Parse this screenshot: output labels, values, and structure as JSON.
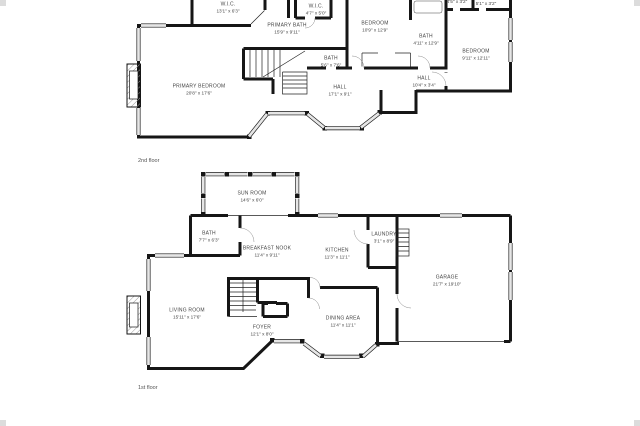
{
  "colors": {
    "wall": "#161616",
    "window": "#e6e6e6",
    "text": "#454545",
    "background": "#ffffff"
  },
  "floors": [
    {
      "label": "2nd floor",
      "rooms": [
        {
          "name": "W.I.C.",
          "dims": "13'1\" x 6'3\""
        },
        {
          "name": "PRIMARY BATH",
          "dims": "15'9\" x 9'11\""
        },
        {
          "name": "W.I.C.",
          "dims": "4'7\" x 5'0\""
        },
        {
          "name": "BEDROOM",
          "dims": "10'9\" x 12'9\""
        },
        {
          "name": "BATH",
          "dims": "4'11\" x 12'9\""
        },
        {
          "name": "",
          "dims": "4'5\" x 3'2\""
        },
        {
          "name": "",
          "dims": "5'1\" x 3'2\""
        },
        {
          "name": "BEDROOM",
          "dims": "9'11\" x 12'11\""
        },
        {
          "name": "HALL",
          "dims": "10'4\" x 3'4\""
        },
        {
          "name": "BATH",
          "dims": "5'6\" x 7'6\""
        },
        {
          "name": "HALL",
          "dims": "17'1\" x 9'1\""
        },
        {
          "name": "PRIMARY BEDROOM",
          "dims": "20'8\" x 17'6\""
        }
      ]
    },
    {
      "label": "1st floor",
      "rooms": [
        {
          "name": "SUN ROOM",
          "dims": "14'6\" x 6'0\""
        },
        {
          "name": "BATH",
          "dims": "7'7\" x 6'3\""
        },
        {
          "name": "BREAKFAST NOOK",
          "dims": "11'4\" x 9'11\""
        },
        {
          "name": "KITCHEN",
          "dims": "11'3\" x 11'1\""
        },
        {
          "name": "LAUNDRY",
          "dims": "3'1\" x 8'9\""
        },
        {
          "name": "GARAGE",
          "dims": "21'7\" x 19'10\""
        },
        {
          "name": "LIVING ROOM",
          "dims": "15'11\" x 17'6\""
        },
        {
          "name": "FOYER",
          "dims": "12'1\" x 8'0\""
        },
        {
          "name": "DINING AREA",
          "dims": "11'4\" x 11'1\""
        }
      ]
    }
  ]
}
